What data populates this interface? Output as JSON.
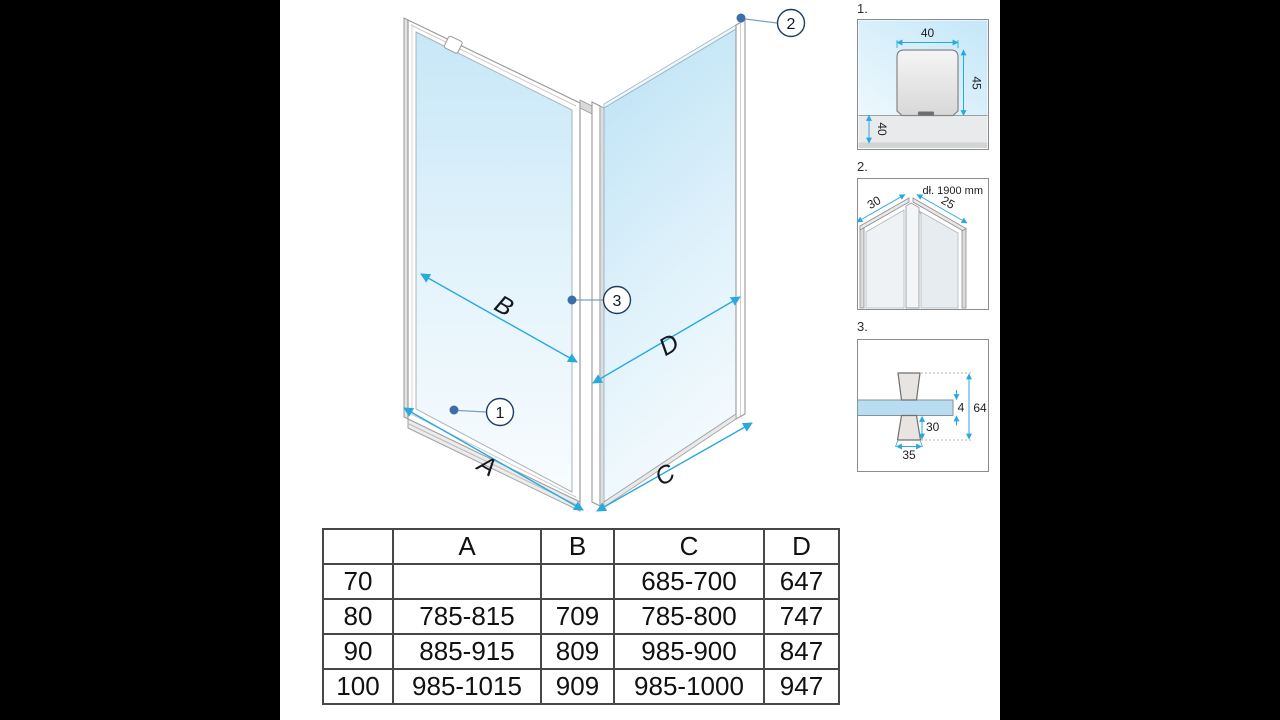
{
  "colors": {
    "accent_blue": "#29a9e0",
    "callout_dot_blue": "#3d6ea9",
    "glass_blue": "#c7e7f8",
    "frame_gray": "#999999",
    "table_border": "#474747",
    "side_bars": "#000000"
  },
  "diagram": {
    "dim_labels": [
      "A",
      "B",
      "C",
      "D"
    ],
    "callouts": [
      "1",
      "2",
      "3"
    ]
  },
  "details": [
    {
      "index": "1.",
      "dim_width": "40",
      "dim_height": "45",
      "dim_floor": "40"
    },
    {
      "index": "2.",
      "note": "dł. 1900 mm",
      "dim_left": "30",
      "dim_right": "25"
    },
    {
      "index": "3.",
      "dim_glass": "4",
      "dim_total": "64",
      "dim_lower": "30",
      "dim_knob": "35"
    }
  ],
  "table": {
    "headers": [
      "",
      "A",
      "B",
      "C",
      "D"
    ],
    "rows": [
      [
        "70",
        "",
        "",
        "685-700",
        "647"
      ],
      [
        "80",
        "785-815",
        "709",
        "785-800",
        "747"
      ],
      [
        "90",
        "885-915",
        "809",
        "985-900",
        "847"
      ],
      [
        "100",
        "985-1015",
        "909",
        "985-1000",
        "947"
      ]
    ]
  }
}
